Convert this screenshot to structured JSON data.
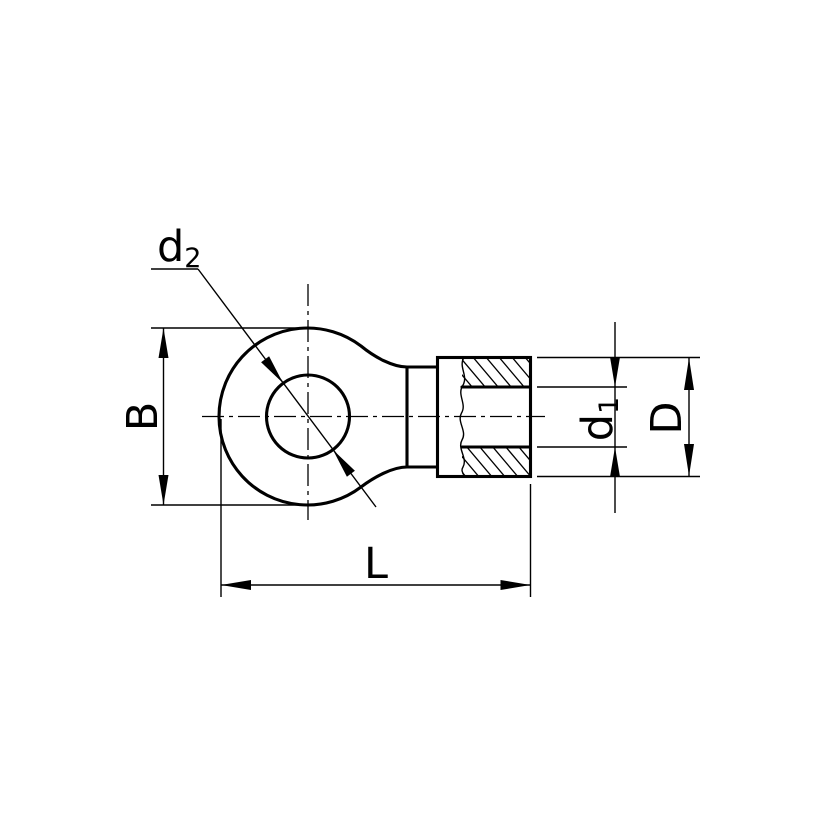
{
  "drawing": {
    "background_color": "#ffffff",
    "line_color": "#000000",
    "labels": {
      "d2": {
        "main": "d",
        "sub": "2"
      },
      "B": {
        "main": "B"
      },
      "d1": {
        "main": "d",
        "sub": "1"
      },
      "D": {
        "main": "D"
      },
      "L": {
        "main": "L"
      }
    }
  }
}
